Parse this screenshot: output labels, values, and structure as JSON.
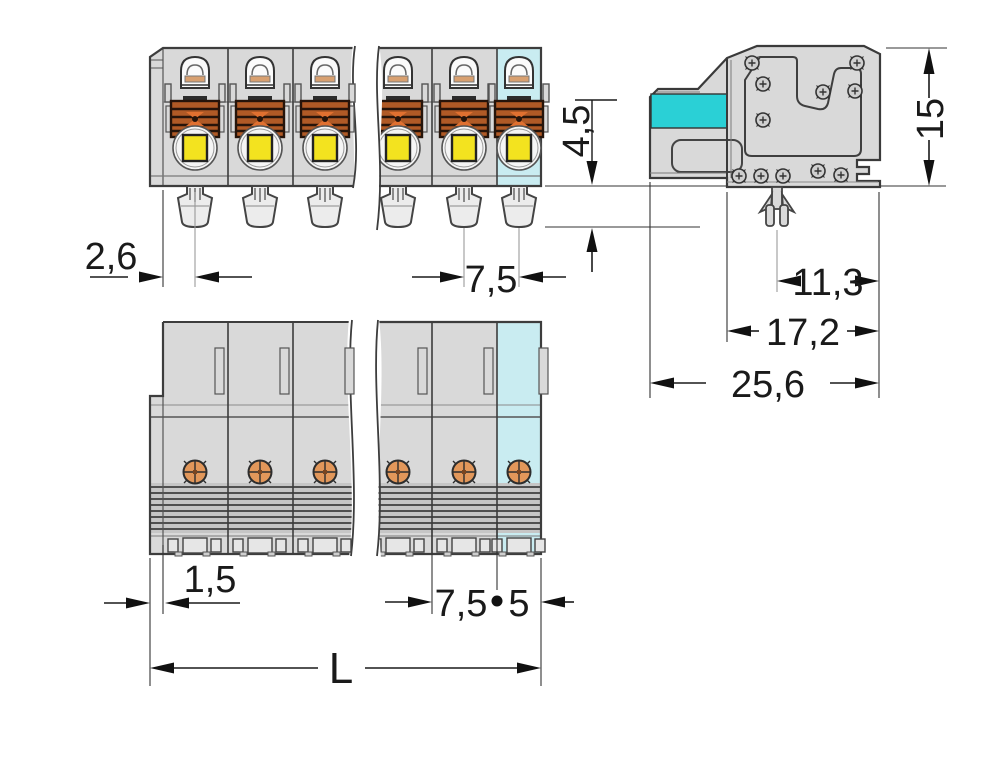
{
  "drawing": {
    "kind": "dimensioned technical drawing, 3 views of a multi-pole plug connector with snap-in feet",
    "views": {
      "front": "front view (top left)",
      "bottom": "bottom view (lower left)",
      "side": "side view (right)"
    }
  },
  "dims": {
    "edge_to_first_foot": "2,6",
    "pitch_top": "7,5",
    "foot_height": "4,5",
    "height": "15",
    "foot_to_edge": "11,3",
    "body_depth": "17,2",
    "total_depth": "25,6",
    "edge_inset": "1,5",
    "pitch_bottom": "7,5",
    "pitch_multiplier": "5",
    "length": "L"
  },
  "colors": {
    "body_gray": "#d9d9d9",
    "pole_highlight_cyan": "#c9ecf1",
    "side_highlight_cyan": "#2ad0d6",
    "contact_orange": "#e2975a",
    "button_yellow": "#f3e31f"
  }
}
